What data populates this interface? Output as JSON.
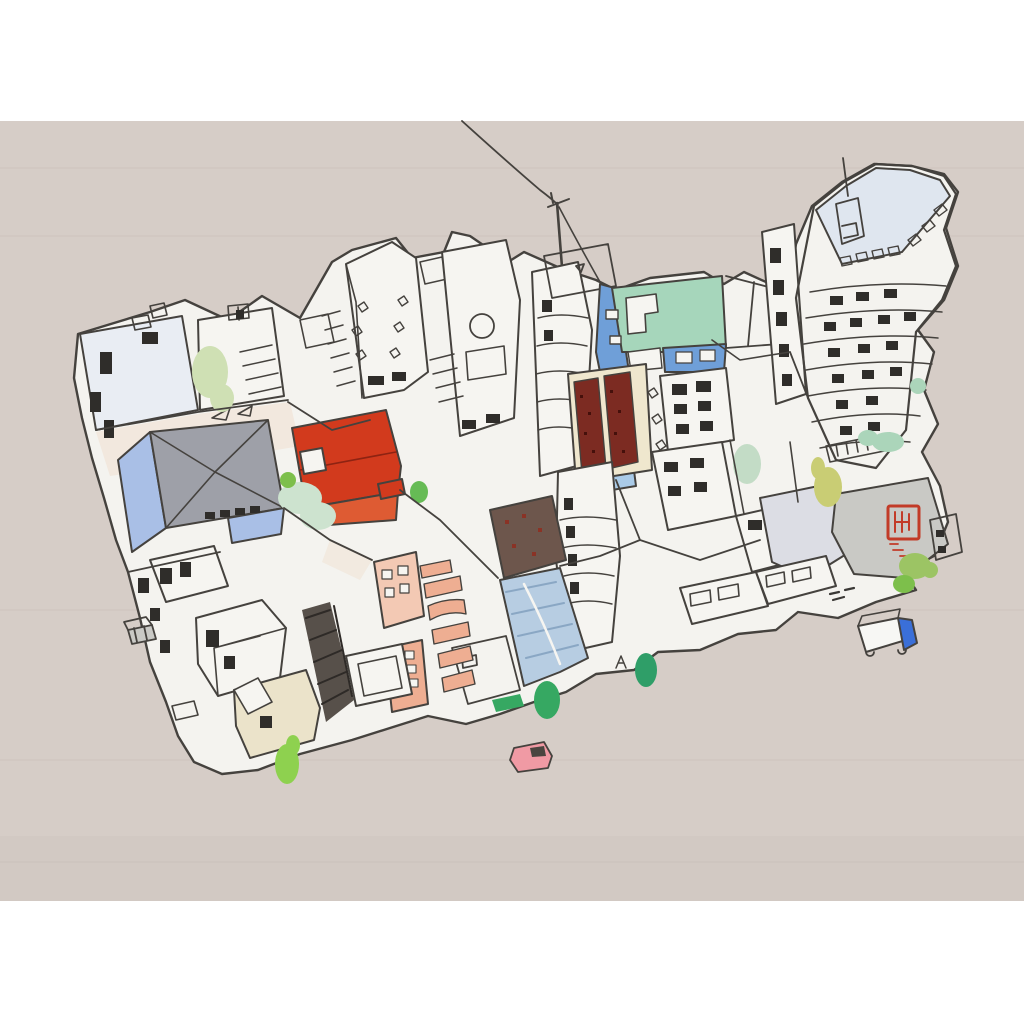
{
  "artwork": {
    "type": "painting",
    "medium": "pen and ink with watercolor on warm grey ground",
    "subject": "aerial view of a dense, tilted city block of hand-drawn buildings",
    "background": "#d6cdc7",
    "margin_color": "#ffffff"
  },
  "palette": {
    "band": "#ffffff",
    "bg": "#d6cdc7",
    "bg_shade": "#cfc5bf",
    "texture": "#c4bab3",
    "ink": "#45423e",
    "ink_dark": "#2f2d2a",
    "base": "#f4f3ef",
    "white": "#f6f5f1",
    "pale_roof": "#e9edf3",
    "tower_roof": "#dfe6ef",
    "grey_roof": "#9ea0a8",
    "blue_wall": "#a9bfe6",
    "light_blue": "#aacbe8",
    "blue_building": "#6f9fd8",
    "teal_roof": "#a6d6bb",
    "red_roof": "#d23a1d",
    "red_front": "#de5b33",
    "red_dark": "#8e2312",
    "maroon": "#7c2b22",
    "maroon_dot": "#45100b",
    "cream": "#efe7ce",
    "cream_wall": "#ebe3ca",
    "brown_roof": "#6d564c",
    "brown_dot": "#8a3326",
    "blue_road": "#b7cde2",
    "road_stripe": "#8aa7c4",
    "salmon": "#eeae92",
    "salmon_light": "#f3c9b4",
    "lavender": "#dcdde4",
    "grey_plate": "#c9c9c5",
    "seal_red": "#c23b28",
    "peach": "#f0e1d2",
    "hatch_dark": "#57504a",
    "hatch_line": "#2e2a27",
    "grill": "#3a3835",
    "tree_pale": "#cfe0b4",
    "tree_mint": "#cde3cf",
    "tree_mint2": "#c3dcc6",
    "tree_mint3": "#abd5ba",
    "tree_green": "#66bb55",
    "tree_bright": "#8ed14f",
    "tree_olive": "#c9cd74",
    "tree_mid": "#9cc464",
    "tree_mid2": "#7dbf4b",
    "tree_emerald": "#36a862",
    "tree_emerald2": "#2f9e68",
    "car_pink": "#f09aa4",
    "car_window": "#4a4540",
    "truck_blue": "#3a6fd8",
    "truck_white": "#f7f7f4"
  },
  "elements": {
    "power_line": "wire from top edge down to a utility pole, then into the rooftops",
    "city_block": "tilted dense block of sketchy white buildings seen from above",
    "high_rise": "tall tower at upper right with pale blue roof, cupola, antenna and wavy window floors",
    "teal_roof_building": "mint-green flat roof with blue walls and blue stair tower",
    "red_roof_building": "bright red-orange hipped roof near center left",
    "grey_pyramid_building": "grey pyramid roof with periwinkle blue walls",
    "maroon_towers": "pair of dark-red speckled slab towers on cream base",
    "brown_roof": "dark speckled brown roof at center bottom",
    "blue_road": "blue hatched sloping road with pale center line",
    "salmon_buildings": "peach facades with zigzag balconies and window grids",
    "artist_seal": "square red seal with illegible carved characters on a grey roof",
    "letter_a_mark": "A",
    "truck": "small white box truck with blue cab at lower right",
    "car": "small pink car at bottom center",
    "dumpster": "tiny grey bin at left edge",
    "trees": "scattered watercolor trees in mint, olive and bright green"
  }
}
